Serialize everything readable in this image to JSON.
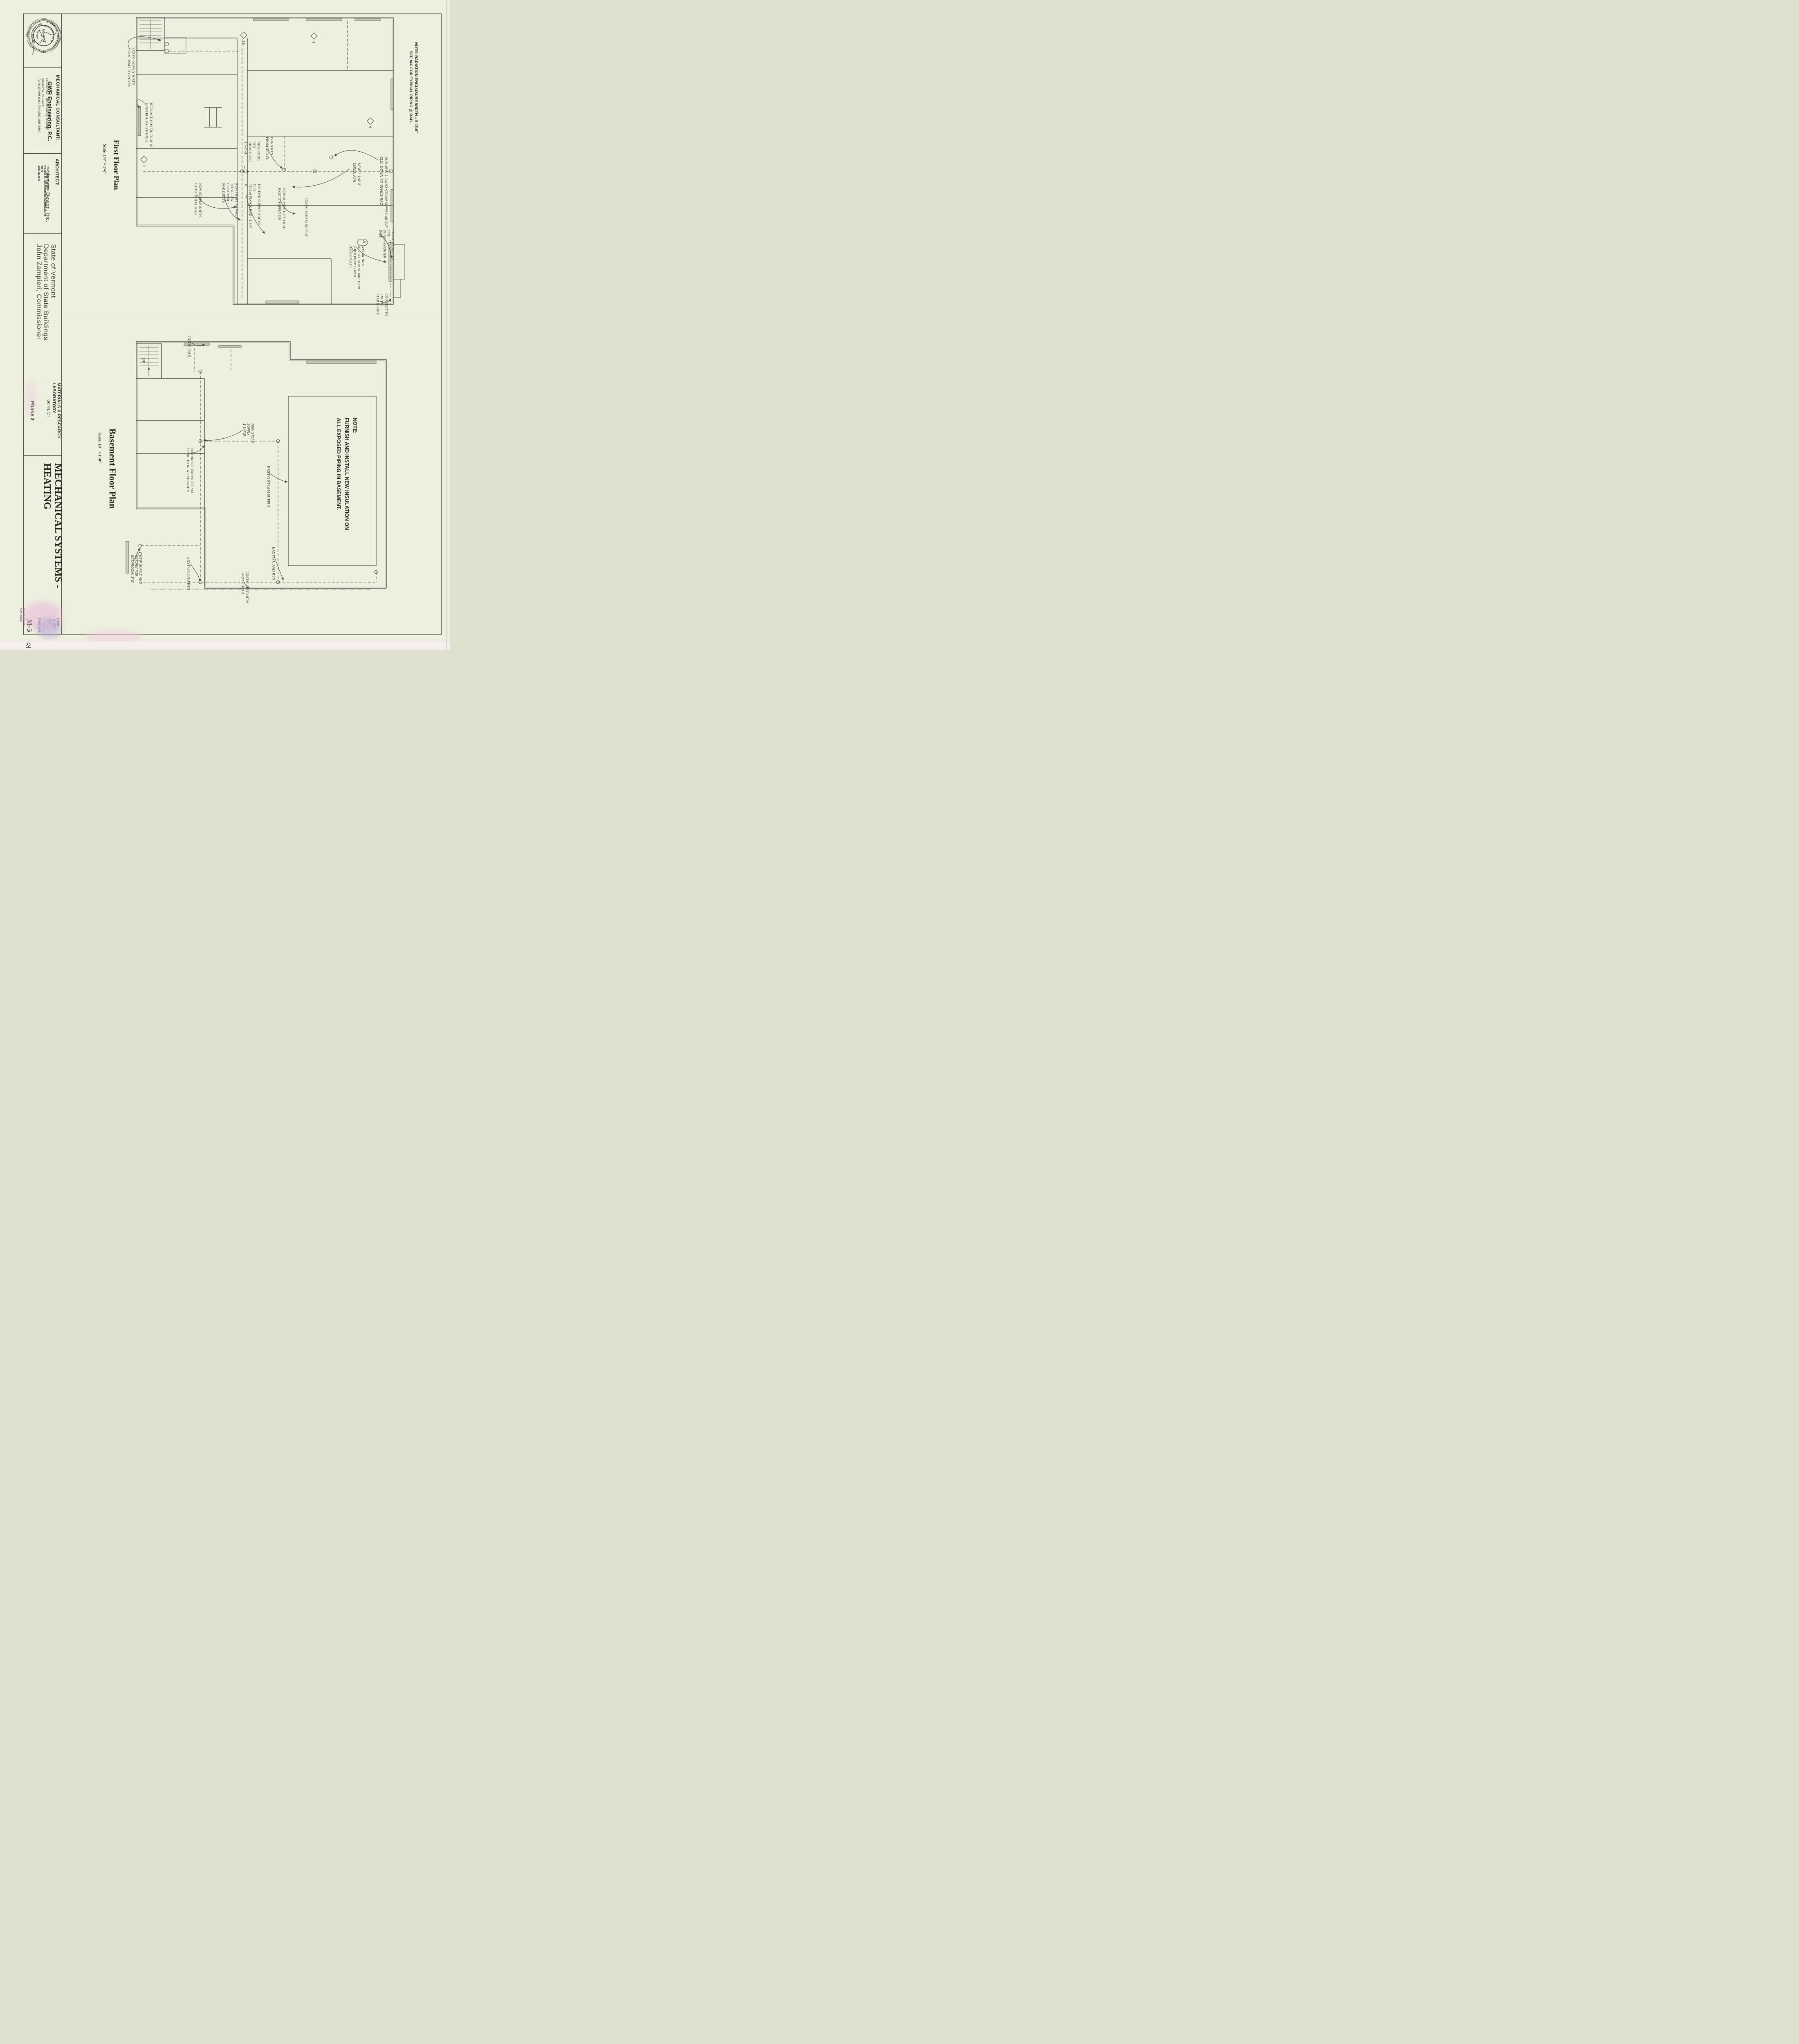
{
  "sheet": {
    "stamp": {
      "ring_top": "STATE OF VERMONT",
      "ring_bottom": "PROFESSIONAL ENGINEER",
      "name": "GORDON W. ROOT, JR.",
      "registered": "REGISTERED",
      "number": "NO. 5704"
    },
    "consultant": {
      "heading": "MECHANICAL CONSULTANT:",
      "name": "GWR Engineering, P.C.",
      "address": "PO Box 157 - The Creamery Building\nShelburne, VT  05482\nTel (802) 985-8061  FAX (802) 985-8499"
    },
    "architect": {
      "heading": "ARCHITECT:",
      "name": "Janson Design, Inc.",
      "address": "FRED KEIL, ARCHITECT\nP.O. BOX 55 - BOLTON ROAD, WATERBURY, VT  05676\n(802) 244-5800"
    },
    "owner": "State of Vermont\nDepartment of State Buildings\nJohn Zampieri, Commissioner",
    "project": {
      "name": "MATERIALS & RESEARCH LABORATORY",
      "location": "Berlin, VT",
      "phase": "Phase 2"
    },
    "sheet_title": "MECHANICAL SYSTEMS - HEATING",
    "date_label": "DATE:",
    "date": "4-20-90",
    "dwg_label": "DWG. NO.",
    "dwg_no": "M-5",
    "edge_note": "PHASE II DWGS CONTINUED"
  },
  "first_floor": {
    "title": "First Floor Plan",
    "scale": "Scale:  1/4\" = 1'-0\"",
    "rad_note": "NOTE:  RADIATION ENCLOSURE WIDTH = 5-1/16\"\n        SEE M-6 FOR TYPICAL PIPING @ RAD.",
    "ann": {
      "supply_bsmt": "EXST'G SUPPLY & RTN\nFROM BSMT TO 2ND FL",
      "replace_cover": "REPLACE COVER, TRAP &\nCONTROL VALVE ONLY",
      "new_supply_2nd": "NEW SUPPLY & RTN\nUP TO 2ND FL RAD.",
      "run_tight": "RUN TIGHT TO WALL\nTO ALLOW CLEARANCE\nFOR DUCTS",
      "extend_supply": "EXTEND SUPPLY ABOVE CLG\nTO 2nd FLOOR RAD - 1 1/4\" Ø",
      "new_cond": "NEW COND RTN\nABOVE CLG\n1 1/4\" Ø",
      "cond_rtn_2nd": "COND RTN\nFROM 2ND FL",
      "new_supply_rad": "NEW SUPPLY UP TO RAD\nEXST'G SUPPLY DN",
      "exstg_steam": "EXST'G STEAM SUPPLY",
      "new_cond_hand": "NEW 1 1/4\"Ø\nCOND. RTN.",
      "run_new_hand": "RUN NEW 1 1/4\"Ø STEAM SUPPLY ABOVE\nCLG. DOWN TO OFFICE RAD.",
      "special_note": "SPECIAL NOTE:\nTHIS SECTION OF RAD TO BE\n3-TIER W/24\" COVER\n(1960 BTU/LF.)",
      "cover_butt": "COVER TO BUTT TO SIDE\nOF NEW COUNTER BASE",
      "connect_exstg": "CONNECT TO EXST'G\nSTEAM LINE"
    },
    "tags": {
      "a": "A",
      "n3": "3",
      "n18": "18",
      "n4": "4",
      "n9": "9",
      "n5": "5,"
    }
  },
  "basement": {
    "title": "Basement Floor Plan",
    "scale": "Scale:  1/4\" = 1'-0\"",
    "note": "NOTE:\nFURNISH AND INSTALL NEW INSULATION ON\nALL EXPOSED PIPING IN BASEMENT.",
    "ann": {
      "fl2_rad": "2ND FL RAD.",
      "new_steam": "NEW STEAM\nSUPPLY\n1 1/4\"Ø",
      "reconnect": "RECONNECT EXST'G STEAM\nPIPING TO NEW RADIATION",
      "exstg_steam": "EXST'G STEAM SUPPLY",
      "bathroom": "NEW SUPPLY AND\nRETURN FOR\nBATHROOM; 1\"Ø",
      "cond1": "EXST'G COND RTN",
      "under_slab": "EXST'G COND RTN\nUNDER SLAB",
      "cond2": "EXST'G COND RTN",
      "up": "UP"
    }
  }
}
